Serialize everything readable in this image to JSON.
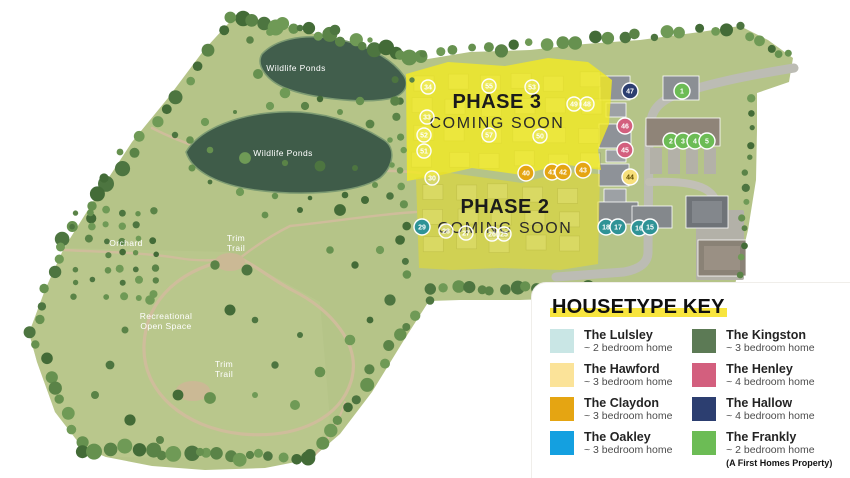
{
  "map": {
    "labels": [
      {
        "id": "wildlife-ponds-1",
        "lines": [
          "Wildlife Ponds"
        ],
        "x": 296,
        "y": 71
      },
      {
        "id": "wildlife-ponds-2",
        "lines": [
          "Wildlife Ponds"
        ],
        "x": 283,
        "y": 156
      },
      {
        "id": "orchard",
        "lines": [
          "Orchard"
        ],
        "x": 126,
        "y": 246
      },
      {
        "id": "trim-trail-1",
        "lines": [
          "Trim",
          "Trail"
        ],
        "x": 236,
        "y": 241
      },
      {
        "id": "recreational-open-space",
        "lines": [
          "Recreational",
          "Open Space"
        ],
        "x": 166,
        "y": 319
      },
      {
        "id": "trim-trail-2",
        "lines": [
          "Trim",
          "Trail"
        ],
        "x": 224,
        "y": 367
      }
    ],
    "phases": [
      {
        "id": "phase-3",
        "title": "PHASE 3",
        "subtitle": "COMING SOON",
        "x": 497,
        "y": 108
      },
      {
        "id": "phase-2",
        "title": "PHASE 2",
        "subtitle": "COMING SOON",
        "x": 505,
        "y": 213
      }
    ],
    "plot_styles": {
      "outline": {
        "fill": "rgba(255,255,255,0.14)",
        "stroke": "#ffffff",
        "text": "#ffffff"
      },
      "claydon": {
        "fill": "#e5a512",
        "stroke": "#ffffff",
        "text": "#ffffff"
      },
      "hawford": {
        "fill": "#f7df7a",
        "stroke": "#ffffff",
        "text": "#5d4a00"
      },
      "henley": {
        "fill": "#d35f7e",
        "stroke": "#ffffff",
        "text": "#ffffff"
      },
      "hallow": {
        "fill": "#2c3e70",
        "stroke": "#ffffff",
        "text": "#ffffff"
      },
      "frankly": {
        "fill": "#6cbc55",
        "stroke": "#ffffff",
        "text": "#ffffff"
      },
      "teal": {
        "fill": "#2f9396",
        "stroke": "#ffffff",
        "text": "#ffffff"
      }
    },
    "plots": [
      {
        "n": "34",
        "x": 428,
        "y": 87,
        "style": "outline"
      },
      {
        "n": "55",
        "x": 489,
        "y": 86,
        "style": "outline"
      },
      {
        "n": "53",
        "x": 532,
        "y": 87,
        "style": "outline"
      },
      {
        "n": "33",
        "x": 427,
        "y": 117,
        "style": "outline"
      },
      {
        "n": "52",
        "x": 424,
        "y": 135,
        "style": "outline"
      },
      {
        "n": "51",
        "x": 424,
        "y": 151,
        "style": "outline"
      },
      {
        "n": "57",
        "x": 489,
        "y": 135,
        "style": "outline"
      },
      {
        "n": "50",
        "x": 540,
        "y": 136,
        "style": "outline"
      },
      {
        "n": "49",
        "x": 574,
        "y": 104,
        "style": "outline"
      },
      {
        "n": "48",
        "x": 587,
        "y": 104,
        "style": "outline"
      },
      {
        "n": "30",
        "x": 432,
        "y": 178,
        "style": "outline"
      },
      {
        "n": "28",
        "x": 446,
        "y": 231,
        "style": "outline"
      },
      {
        "n": "27",
        "x": 466,
        "y": 233,
        "style": "outline"
      },
      {
        "n": "26",
        "x": 492,
        "y": 234,
        "style": "outline"
      },
      {
        "n": "25",
        "x": 504,
        "y": 234,
        "style": "outline"
      },
      {
        "n": "40",
        "x": 526,
        "y": 173,
        "style": "claydon"
      },
      {
        "n": "41",
        "x": 552,
        "y": 172,
        "style": "claydon"
      },
      {
        "n": "42",
        "x": 563,
        "y": 172,
        "style": "claydon"
      },
      {
        "n": "43",
        "x": 583,
        "y": 170,
        "style": "claydon"
      },
      {
        "n": "44",
        "x": 630,
        "y": 177,
        "style": "hawford"
      },
      {
        "n": "45",
        "x": 625,
        "y": 150,
        "style": "henley"
      },
      {
        "n": "46",
        "x": 625,
        "y": 126,
        "style": "henley"
      },
      {
        "n": "47",
        "x": 630,
        "y": 91,
        "style": "hallow"
      },
      {
        "n": "29",
        "x": 422,
        "y": 227,
        "style": "teal"
      },
      {
        "n": "18",
        "x": 606,
        "y": 227,
        "style": "teal"
      },
      {
        "n": "17",
        "x": 618,
        "y": 227,
        "style": "teal"
      },
      {
        "n": "16",
        "x": 639,
        "y": 228,
        "style": "teal"
      },
      {
        "n": "15",
        "x": 650,
        "y": 227,
        "style": "teal"
      },
      {
        "n": "1",
        "x": 682,
        "y": 91,
        "style": "frankly"
      },
      {
        "n": "2",
        "x": 671,
        "y": 141,
        "style": "frankly"
      },
      {
        "n": "3",
        "x": 683,
        "y": 141,
        "style": "frankly"
      },
      {
        "n": "4",
        "x": 695,
        "y": 141,
        "style": "frankly"
      },
      {
        "n": "5",
        "x": 707,
        "y": 141,
        "style": "frankly"
      }
    ]
  },
  "legend": {
    "title": "HOUSETYPE KEY",
    "items": [
      {
        "name": "The Lulsley",
        "desc": "~ 2 bedroom home",
        "color": "#c9e6e5"
      },
      {
        "name": "The Hawford",
        "desc": "~ 3 bedroom home",
        "color": "#fbe399"
      },
      {
        "name": "The Claydon",
        "desc": "~ 3 bedroom home",
        "color": "#e5a512"
      },
      {
        "name": "The Oakley",
        "desc": "~ 3 bedroom home",
        "color": "#14a0e0"
      },
      {
        "name": "The Kingston",
        "desc": "~ 3 bedroom home",
        "color": "#5c7a55"
      },
      {
        "name": "The Henley",
        "desc": "~ 4 bedroom home",
        "color": "#d35f7e"
      },
      {
        "name": "The Hallow",
        "desc": "~ 4 bedroom home",
        "color": "#2c3e70"
      },
      {
        "name": "The Frankly",
        "desc": "~ 2 bedroom home",
        "color": "#6cbc55",
        "note": "(A First Homes Property)"
      }
    ]
  },
  "colors": {
    "land": "#b5c488",
    "pond": "#3f5c49",
    "path": "#cfbd9b",
    "road": "#bcbcb4",
    "phase_overlay": "#f4eb22",
    "highlight": "#f8e53e"
  }
}
